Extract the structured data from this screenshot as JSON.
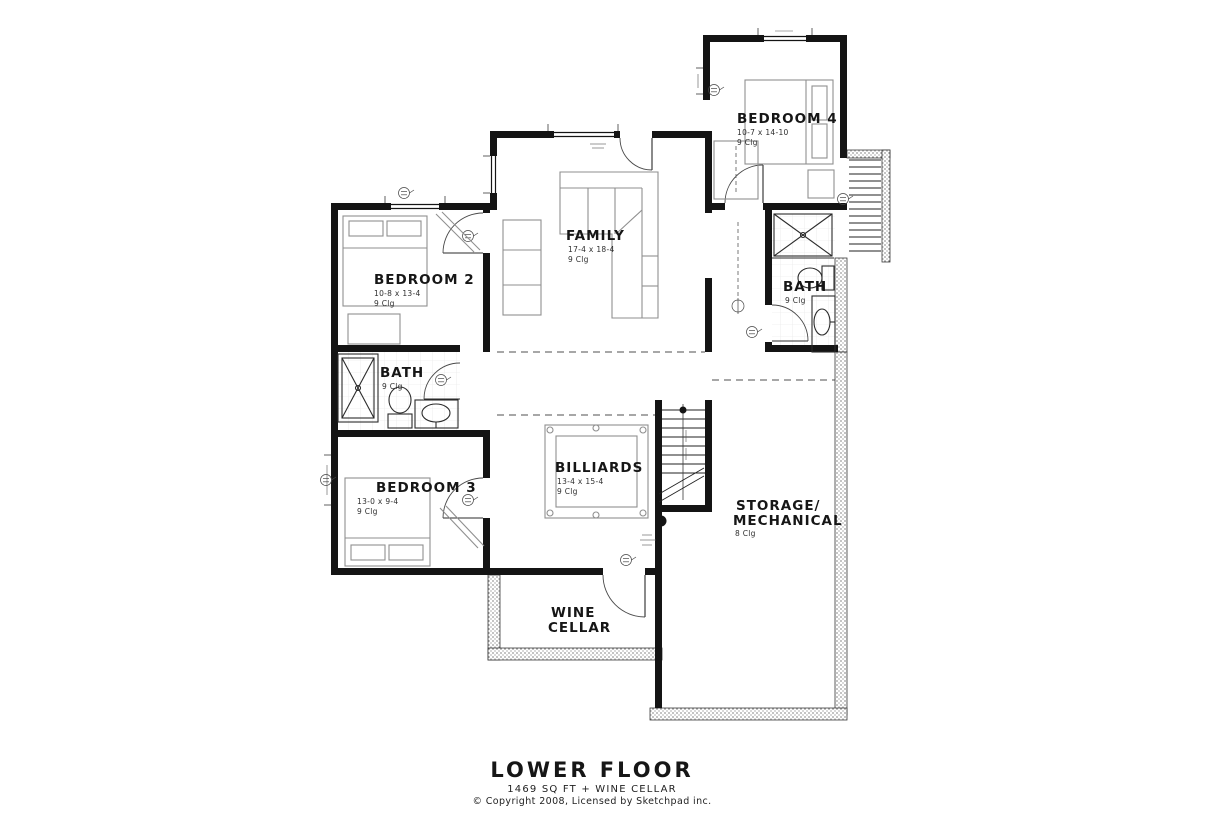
{
  "title_block": {
    "title": "LOWER FLOOR",
    "subtitle": "1469 SQ FT + WINE CELLAR",
    "copyright": "© Copyright 2008, Licensed by Sketchpad inc."
  },
  "rooms": {
    "family": {
      "name": "FAMILY",
      "dims": "17-4 x 18-4",
      "ceiling": "9 Clg"
    },
    "bedroom2": {
      "name": "BEDROOM 2",
      "dims": "10-8 x 13-4",
      "ceiling": "9 Clg"
    },
    "bedroom3": {
      "name": "BEDROOM 3",
      "dims": "13-0 x 9-4",
      "ceiling": "9 Clg"
    },
    "bedroom4": {
      "name": "BEDROOM 4",
      "dims": "10-7 x 14-10",
      "ceiling": "9 Clg"
    },
    "bath_left": {
      "name": "BATH",
      "ceiling": "9 Clg"
    },
    "bath_right": {
      "name": "BATH",
      "ceiling": "9 Clg"
    },
    "billiards": {
      "name": "BILLIARDS",
      "dims": "13-4 x 15-4",
      "ceiling": "9 Clg"
    },
    "storage": {
      "name_line1": "STORAGE/",
      "name_line2": "MECHANICAL",
      "ceiling": "8 Clg"
    },
    "wine_cellar": {
      "name_line1": "WINE",
      "name_line2": "CELLAR"
    }
  },
  "colors": {
    "walls": "#141414",
    "furniture": "#8f8f8f",
    "background": "#ffffff"
  }
}
